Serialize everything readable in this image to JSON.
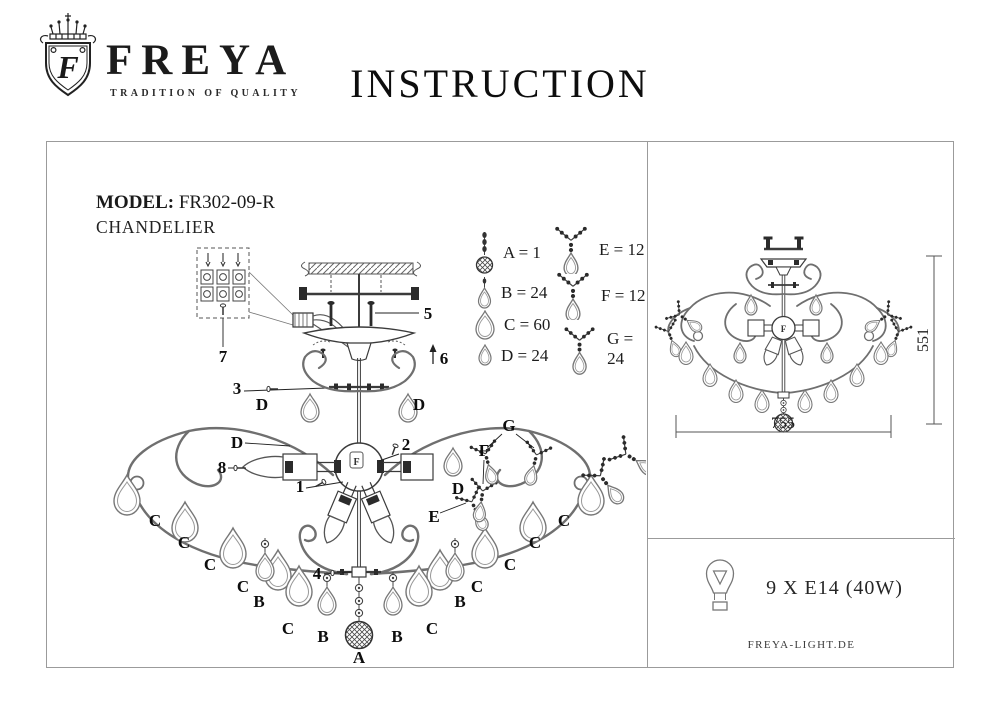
{
  "colors": {
    "background": "#ffffff",
    "ink": "#141414",
    "drawing_line": "#6f6f6f",
    "mechanical_line": "#3b3b3b",
    "panel_border": "#9b9b9b"
  },
  "header": {
    "brand": "FREYA",
    "tagline": "TRADITION OF QUALITY",
    "title": "INSTRUCTION",
    "logo_letter": "F"
  },
  "model": {
    "label": "MODEL:",
    "number": "FR302-09-R",
    "type": "CHANDELIER"
  },
  "diagram": {
    "hub_mark": "F",
    "labels": {
      "p1": "1",
      "p2": "2",
      "p3": "3",
      "p4": "4",
      "p5": "5",
      "p6": "6",
      "p7": "7",
      "p8": "8",
      "A": "A",
      "B": "B",
      "C": "C",
      "D": "D",
      "E": "E",
      "F": "F",
      "G": "G"
    }
  },
  "legend": {
    "items": [
      {
        "id": "A",
        "text": "A = 1",
        "icon": "ball-pendant-icon"
      },
      {
        "id": "B",
        "text": "B = 24",
        "icon": "small-drop-icon"
      },
      {
        "id": "C",
        "text": "C = 60",
        "icon": "drop-icon"
      },
      {
        "id": "D",
        "text": "D = 24",
        "icon": "mini-drop-icon"
      },
      {
        "id": "E",
        "text": "E = 12",
        "icon": "branch-drop-icon"
      },
      {
        "id": "F",
        "text": "F = 12",
        "icon": "branch-drop-icon"
      },
      {
        "id": "G",
        "text": "G = 24",
        "icon": "branch-drop-icon"
      }
    ]
  },
  "dimensions": {
    "width": "755",
    "height": "551"
  },
  "spec": {
    "lamps": "9 X E14 (40W)",
    "website": "FREYA-LIGHT.DE"
  }
}
